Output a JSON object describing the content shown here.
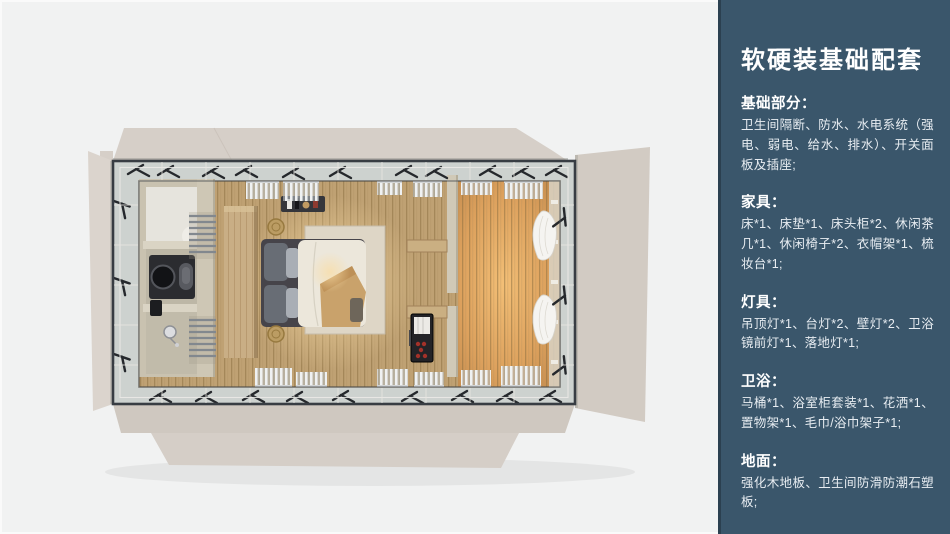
{
  "panel": {
    "title": "软硬装基础配套",
    "sections": [
      {
        "heading": "基础部分：",
        "body": "卫生间隔断、防水、水电系统（强电、弱电、给水、排水）、开关面板及插座;"
      },
      {
        "heading": "家具：",
        "body": "床*1、床垫*1、床头柜*2、休闲茶几*1、休闲椅子*2、衣帽架*1、梳妆台*1;"
      },
      {
        "heading": "灯具：",
        "body": "吊顶灯*1、台灯*2、壁灯*2、卫浴镜前灯*1、落地灯*1;"
      },
      {
        "heading": "卫浴：",
        "body": "马桶*1、浴室柜套装*1、花洒*1、置物架*1、毛巾/浴巾架子*1;"
      },
      {
        "heading": "地面：",
        "body": "强化木地板、卫生间防滑防潮石塑板;"
      }
    ]
  },
  "colors": {
    "page_bg": "#f1f2f2",
    "panel_bg": "#3a566b",
    "panel_edge": "#2b4050",
    "panel_title": "#ffffff",
    "panel_body": "#e8edf2",
    "flap_beige": "#d6cfc8",
    "frame_dark": "#383d43",
    "glass": "#cdd2cf",
    "floor_wood": "#bfa173",
    "warm_glow": "#e2a159",
    "bathroom_wall": "#c9c2b0",
    "headboard_wood": "#c9ae85",
    "bed_duvet": "#ece7db",
    "rug": "#ded6c6",
    "curtain_white": "#f5f4f1",
    "cabinet_red": "#a33129"
  }
}
